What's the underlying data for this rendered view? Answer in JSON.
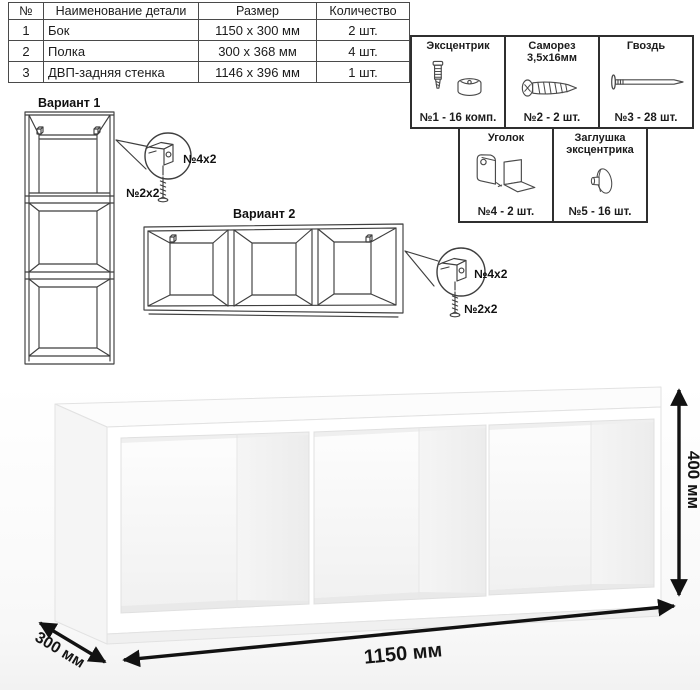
{
  "parts_table": {
    "headers": {
      "num": "№",
      "name": "Наименование детали",
      "size": "Размер",
      "qty": "Количество"
    },
    "rows": [
      {
        "num": "1",
        "name": "Бок",
        "size": "1150 x 300 мм",
        "qty": "2 шт."
      },
      {
        "num": "2",
        "name": "Полка",
        "size": "300 x 368 мм",
        "qty": "4 шт."
      },
      {
        "num": "3",
        "name": "ДВП-задняя стенка",
        "size": "1146 x 396 мм",
        "qty": "1 шт."
      }
    ]
  },
  "hardware": {
    "items": [
      {
        "title": "Эксцентрик",
        "count": "№1 - 16 комп.",
        "icon": "eccentric-cam-icon"
      },
      {
        "title": "Саморез 3,5х16мм",
        "count": "№2 - 2 шт.",
        "icon": "screw-icon"
      },
      {
        "title": "Гвоздь",
        "count": "№3 - 28 шт.",
        "icon": "nail-icon"
      },
      {
        "title": "Уголок",
        "count": "№4 - 2 шт.",
        "icon": "corner-bracket-icon"
      },
      {
        "title": "Заглушка эксцентрика",
        "count": "№5 - 16 шт.",
        "icon": "cam-cover-icon"
      }
    ]
  },
  "variants": {
    "variant1": {
      "label": "Вариант 1",
      "callout": {
        "bracket_label": "№4х2",
        "screw_label": "№2х2"
      }
    },
    "variant2": {
      "label": "Вариант 2",
      "callout": {
        "bracket_label": "№4х2",
        "screw_label": "№2х2"
      }
    }
  },
  "dimensions": {
    "width": "1150 мм",
    "depth": "300 мм",
    "height": "400 мм"
  },
  "colors": {
    "line": "#3f3f3f",
    "dimension": "#121212",
    "shelf_face": "#ffffff"
  }
}
